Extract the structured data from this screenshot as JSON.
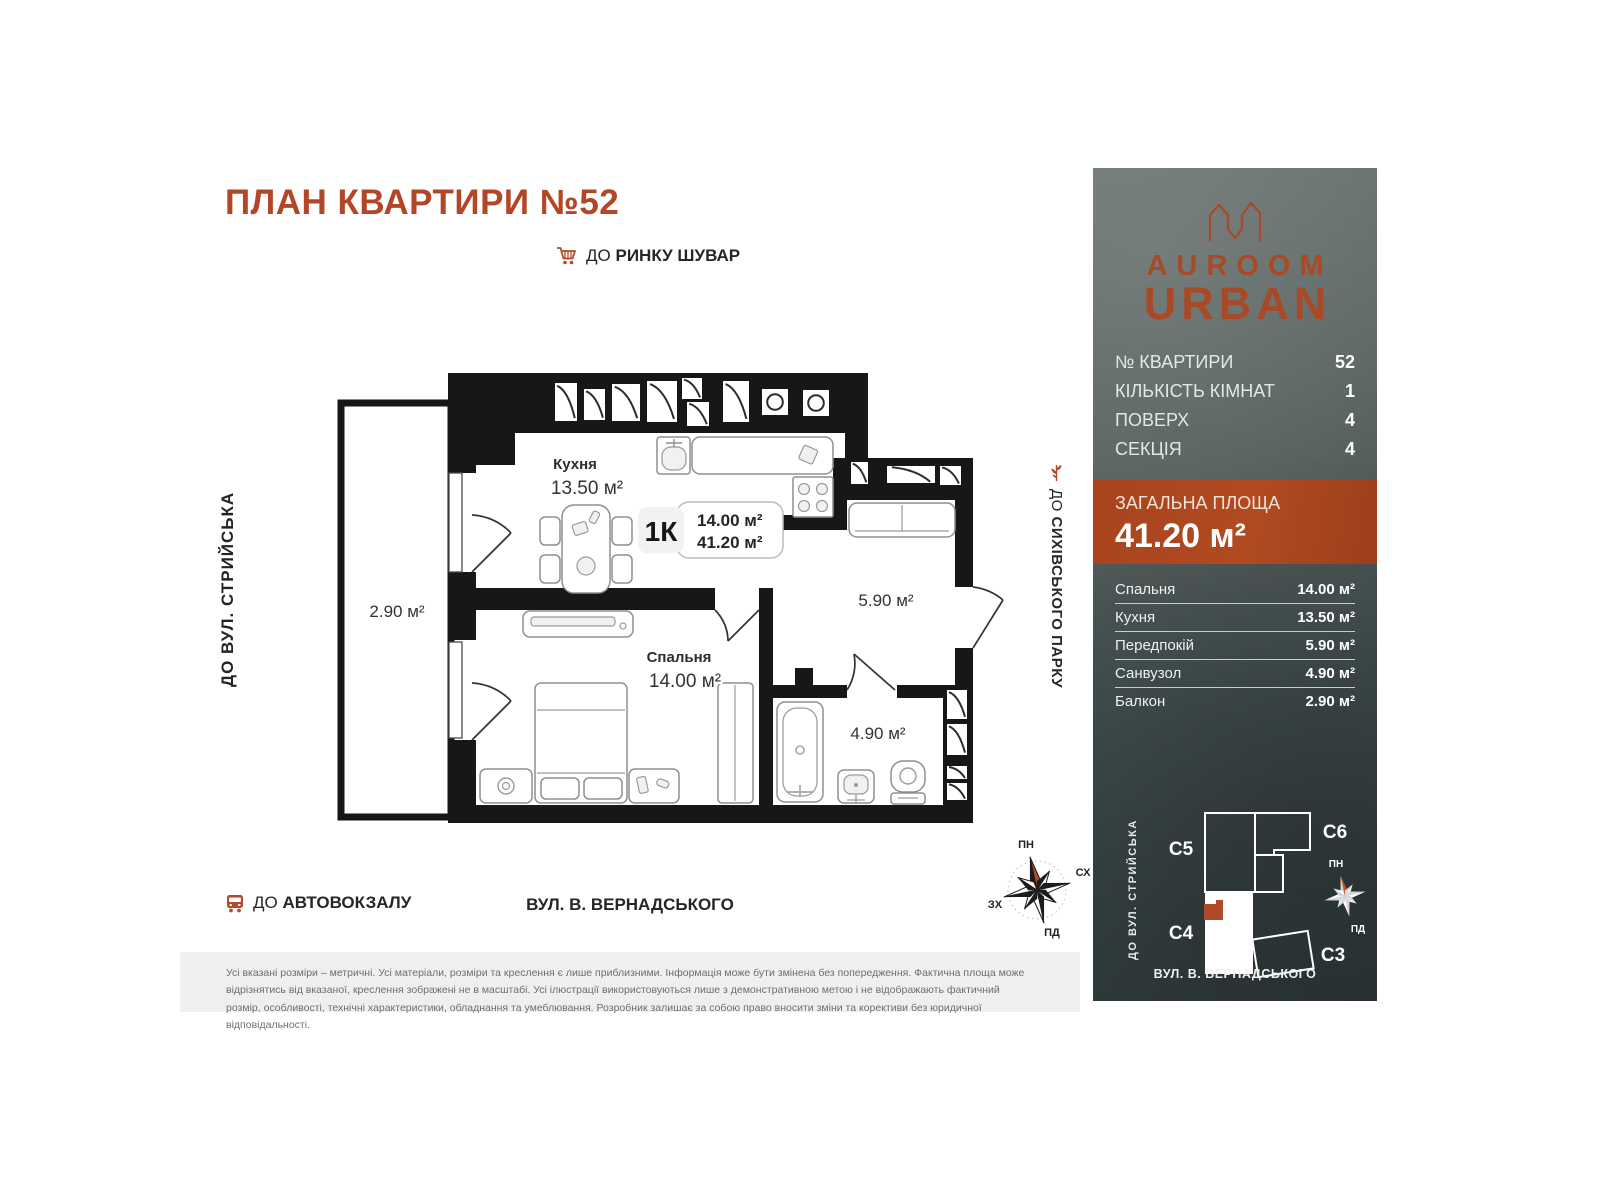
{
  "title": "ПЛАН КВАРТИРИ №52",
  "directions": {
    "market_prefix": "ДО",
    "market_name": "РИНКУ ШУВАР",
    "street_left": "ДО ВУЛ. СТРИЙСЬКА",
    "park_prefix": "ДО",
    "park_name": "СИХІВСЬКОГО ПАРКУ",
    "bus_prefix": "ДО",
    "bus_name": "АВТОВОКЗАЛУ",
    "street_bottom": "ВУЛ. В. ВЕРНАДСЬКОГО"
  },
  "plan": {
    "kitchen_name": "Кухня",
    "kitchen_area": "13.50 м²",
    "bedroom_name": "Спальня",
    "bedroom_area": "14.00 м²",
    "hall_area": "5.90 м²",
    "bath_area": "4.90 м²",
    "balcony_area": "2.90 м²",
    "type_badge": "1К",
    "badge_area_living": "14.00 м²",
    "badge_area_total": "41.20 м²",
    "compass": {
      "n": "ПН",
      "e": "СХ",
      "w": "ЗХ",
      "s": "ПД"
    }
  },
  "panel": {
    "brand_top": "AUROOM",
    "brand_bottom": "URBAN",
    "info": [
      {
        "label": "№ КВАРТИРИ",
        "value": "52"
      },
      {
        "label": "КІЛЬКІСТЬ КІМНАТ",
        "value": "1"
      },
      {
        "label": "ПОВЕРХ",
        "value": "4"
      },
      {
        "label": "СЕКЦІЯ",
        "value": "4"
      }
    ],
    "total_label": "ЗАГАЛЬНА ПЛОЩА",
    "total_value": "41.20 м²",
    "rooms": [
      {
        "label": "Спальня",
        "value": "14.00 м²"
      },
      {
        "label": "Кухня",
        "value": "13.50 м²"
      },
      {
        "label": "Передпокій",
        "value": "5.90 м²"
      },
      {
        "label": "Санвузол",
        "value": "4.90 м²"
      },
      {
        "label": "Балкон",
        "value": "2.90 м²"
      }
    ],
    "sitemap": {
      "street_left": "ДО ВУЛ. СТРИЙСЬКА",
      "street_bottom": "ВУЛ. В. ВЕРНАДСЬКОГО",
      "c5": "C5",
      "c6": "C6",
      "c4": "C4",
      "c3": "C3",
      "compass_n": "ПН",
      "compass_s": "ПД"
    }
  },
  "disclaimer": "Усі вказані розміри – метричні. Усі матеріали, розміри та креслення є лише приблизними. Інформація може бути змінена без попередження. Фактична площа може відрізнятись від вказаної, креслення зображені не в масштабі. Усі ілюстрації використовуються лише з демонстративною метою і не відображають фактичний розмір, особливості, технічні характеристики, обладнання та умеблювання. Розробник залишає за собою право вносити зміни та корективи без юридичної відповідальності.",
  "colors": {
    "accent": "#b34627",
    "panel_orange": "#a8441e",
    "wall": "#171717"
  }
}
